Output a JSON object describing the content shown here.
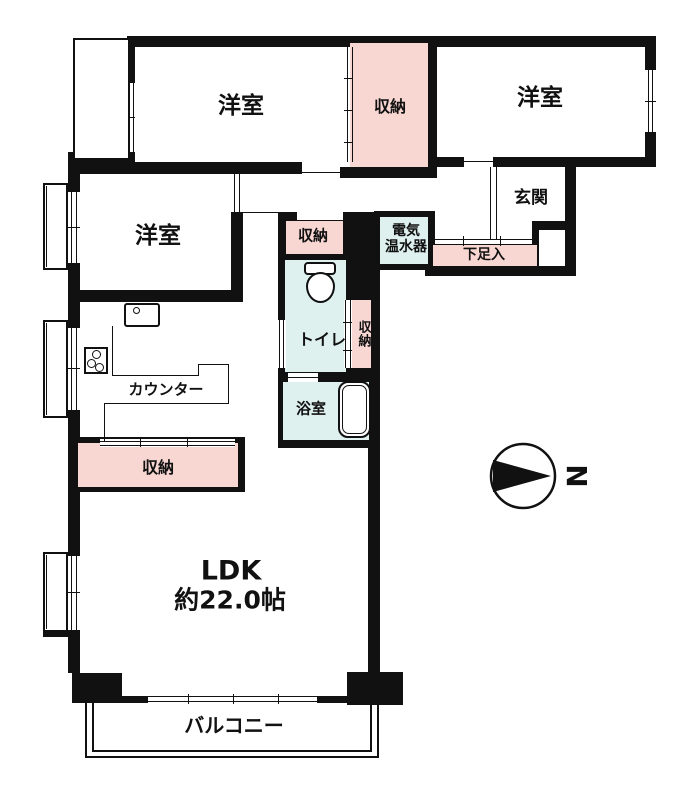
{
  "diagram_type": "apartment-floor-plan",
  "labels": {
    "bedroom_top_left": "洋室",
    "bedroom_top_right": "洋室",
    "bedroom_left": "洋室",
    "closet_top": "収納",
    "closet_hall": "収納",
    "closet_tall": "収納",
    "closet_ldk": "収納",
    "entrance": "玄関",
    "water_heater_line1": "電気",
    "water_heater_line2": "温水器",
    "shoe_cabinet": "下足入",
    "toilet": "トイレ",
    "bathroom": "浴室",
    "counter": "カウンター",
    "ldk_name": "LDK",
    "ldk_size": "約22.0帖",
    "balcony": "バルコニー",
    "compass_north": "N"
  },
  "colors": {
    "wall": "#111111",
    "closet_fill": "#f8d7d3",
    "wet_area_fill": "#def1ee",
    "background": "#ffffff"
  },
  "icons": {
    "toilet": "toilet-icon",
    "bathtub": "bathtub-icon",
    "kitchen_sink": "sink-icon",
    "stove": "stove-icon",
    "compass": "compass-north-icon"
  }
}
